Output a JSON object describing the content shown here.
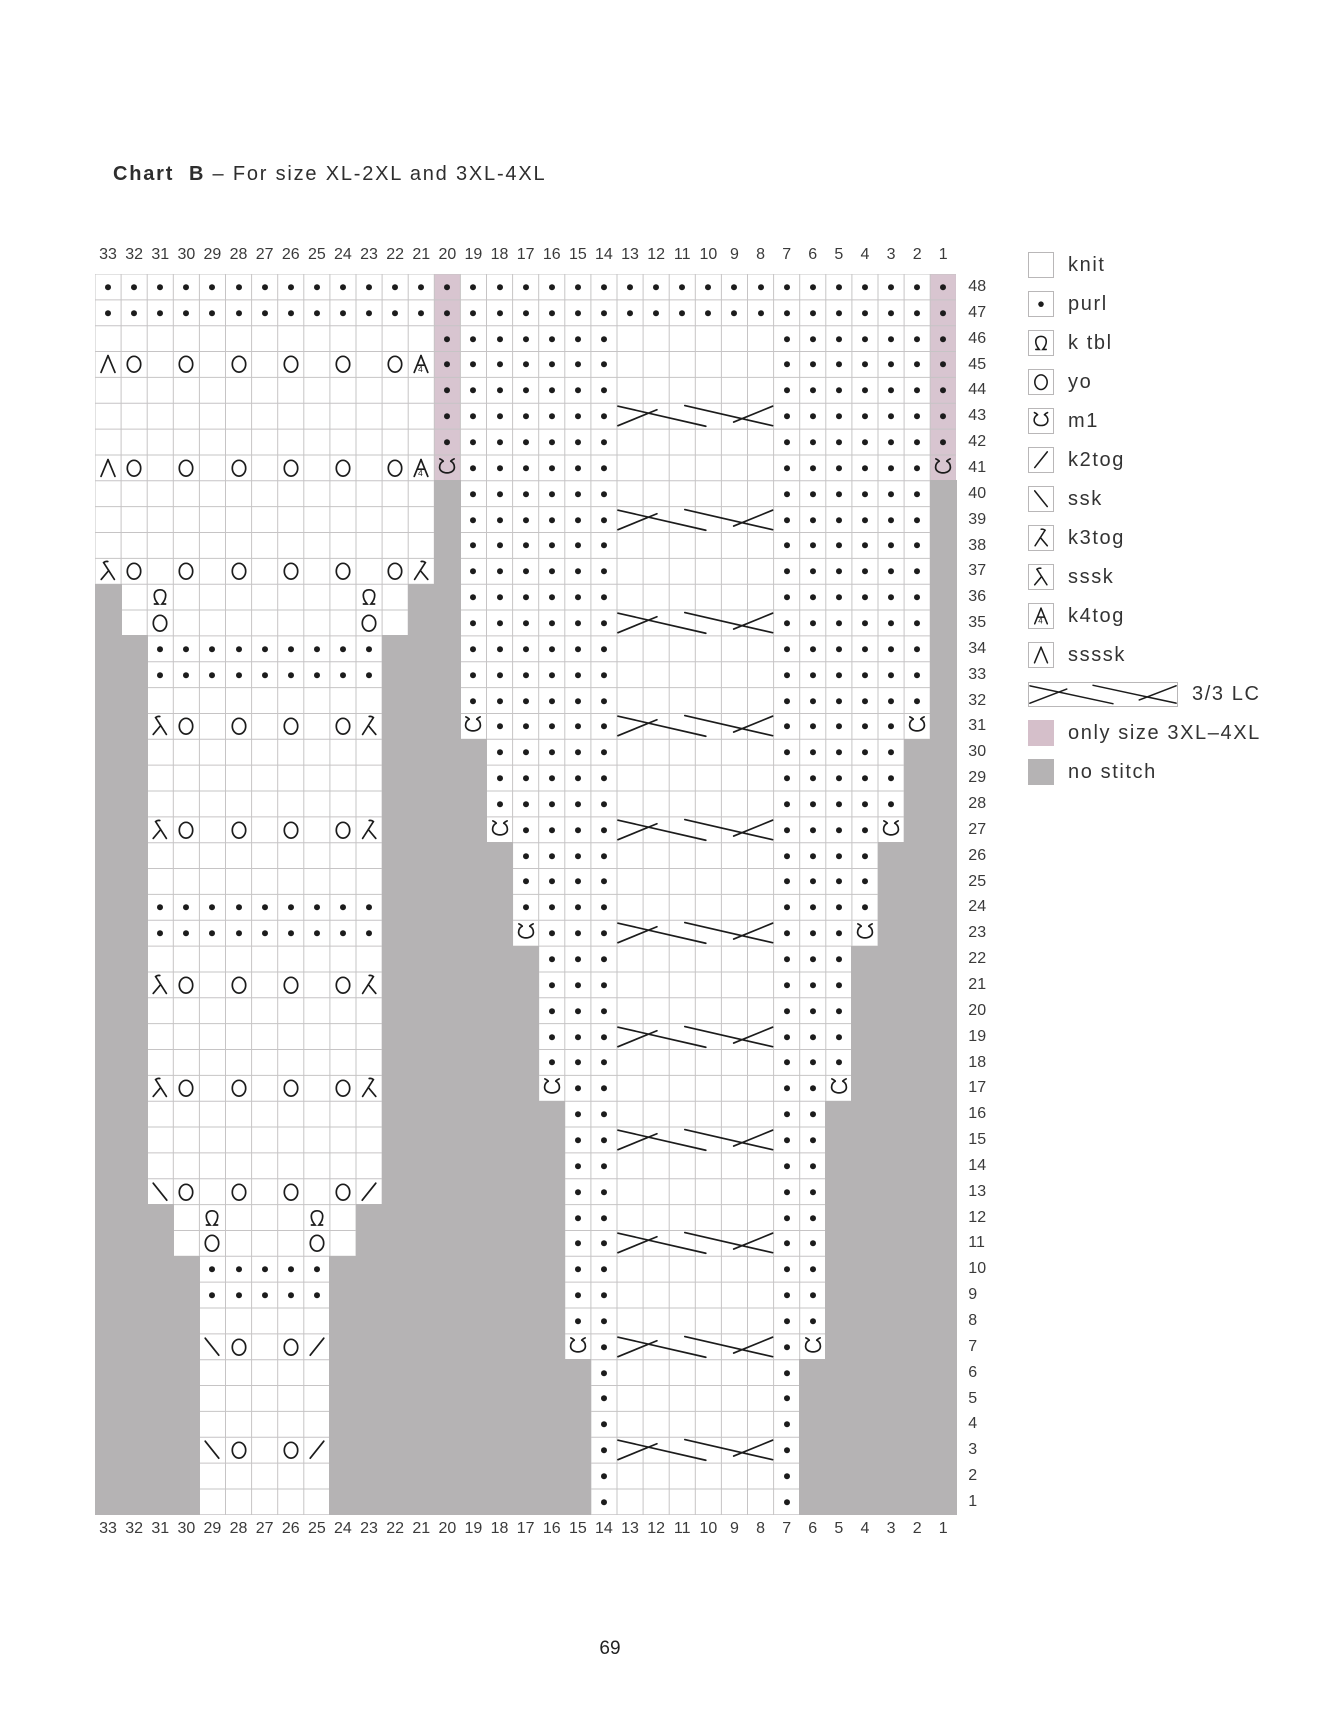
{
  "page": {
    "title_bold": "Chart  B",
    "title_rest": " – For size XL-2XL and 3XL-4XL",
    "page_number": "69"
  },
  "colors": {
    "pink": "#d8c5d0",
    "legend_pink": "#d5bfca",
    "gray": "#b5b3b4",
    "grid_line": "#c6c4c5",
    "symbol": "#1c1c1c",
    "label_text": "#3a3a3a"
  },
  "legend": {
    "items": [
      {
        "key": "knit",
        "label": "knit"
      },
      {
        "key": "purl",
        "label": "purl"
      },
      {
        "key": "ktbl",
        "label": "k tbl"
      },
      {
        "key": "yo",
        "label": "yo"
      },
      {
        "key": "m1",
        "label": "m1"
      },
      {
        "key": "k2tog",
        "label": "k2tog"
      },
      {
        "key": "ssk",
        "label": "ssk"
      },
      {
        "key": "k3tog",
        "label": "k3tog"
      },
      {
        "key": "sssk",
        "label": "sssk"
      },
      {
        "key": "k4tog",
        "label": "k4tog"
      },
      {
        "key": "ssssk",
        "label": "ssssk"
      },
      {
        "key": "cable",
        "label": "3/3 LC"
      },
      {
        "key": "only3xl",
        "label": "only size 3XL–4XL"
      },
      {
        "key": "nostitch",
        "label": "no stitch"
      }
    ]
  },
  "chart_data": {
    "type": "table",
    "subtype": "knitting-stitch-chart",
    "title": "Chart B – For size XL-2XL and 3XL-4XL",
    "column_labels": [
      33,
      32,
      31,
      30,
      29,
      28,
      27,
      26,
      25,
      24,
      23,
      22,
      21,
      20,
      19,
      18,
      17,
      16,
      15,
      14,
      13,
      12,
      11,
      10,
      9,
      8,
      7,
      6,
      5,
      4,
      3,
      2,
      1
    ],
    "column_labels_shown": "top and bottom",
    "row_labels": [
      48,
      47,
      46,
      45,
      44,
      43,
      42,
      41,
      40,
      39,
      38,
      37,
      36,
      35,
      34,
      33,
      32,
      31,
      30,
      29,
      28,
      27,
      26,
      25,
      24,
      23,
      22,
      21,
      20,
      19,
      18,
      17,
      16,
      15,
      14,
      13,
      12,
      11,
      10,
      9,
      8,
      7,
      6,
      5,
      4,
      3,
      2,
      1
    ],
    "row_labels_shown": "right side",
    "cell_tokens": {
      ".": "knit (empty cell)",
      "p": "purl",
      "Q": "k tbl",
      "O": "yo",
      "M": "m1",
      "/": "k2tog",
      "\\": "ssk",
      "K": "k3tog",
      "S": "sssk",
      "4": "k4tog",
      "A": "ssssk",
      "C": "3/3 LC cable (6-cell span)",
      "G": "no stitch (gray)",
      "P": "purl on pink = only size 3XL-4XL",
      "N": "m1 on pink = only size 3XL-4XL"
    },
    "rows": [
      "pppppppppppppPppppppppppppppppppP",
      "pppppppppppppPppppppppppppppppppP",
      ".............Ppppppp......ppppppP",
      "AO.O.O.O.O.O4Ppppppp......ppppppP",
      ".............Ppppppp......ppppppP",
      ".............PppppppCCCCCCppppppP",
      ".............Ppppppp......ppppppP",
      "AO.O.O.O.O.O4Npppppp......ppppppN",
      ".............Gpppppp......ppppppG",
      ".............GppppppCCCCCCppppppG",
      ".............Gpppppp......ppppppG",
      "SO.O.O.O.O.OKGpppppp......ppppppG",
      "G.Q.......Q.GGpppppp......ppppppG",
      "G.O.......O.GGppppppCCCCCCppppppG",
      "GGpppppppppGGGpppppp......ppppppG",
      "GGpppppppppGGGpppppp......ppppppG",
      "GG.........GGGpppppp......ppppppG",
      "GGSO.O.O.OKGGGMpppppCCCCCCpppppMG",
      "GG.........GGGGppppp......pppppGG",
      "GG.........GGGGppppp......pppppGG",
      "GG.........GGGGppppp......pppppGG",
      "GGSO.O.O.OKGGGGMppppCCCCCCppppMGG",
      "GG.........GGGGGpppp......ppppGGG",
      "GG.........GGGGGpppp......ppppGGG",
      "GGpppppppppGGGGGpppp......ppppGGG",
      "GGpppppppppGGGGGMpppCCCCCCpppMGGG",
      "GG.........GGGGGGppp......pppGGGG",
      "GGSO.O.O.OKGGGGGGppp......pppGGGG",
      "GG.........GGGGGGppp......pppGGGG",
      "GG.........GGGGGGpppCCCCCCpppGGGG",
      "GG.........GGGGGGppp......pppGGGG",
      "GGSO.O.O.OKGGGGGGMpp......ppMGGGG",
      "GG.........GGGGGGGpp......ppGGGGG",
      "GG.........GGGGGGGppCCCCCCppGGGGG",
      "GG.........GGGGGGGpp......ppGGGGG",
      "GG\\O.O.O.O/GGGGGGGpp......ppGGGGG",
      "GGG.Q...Q.GGGGGGGGpp......ppGGGGG",
      "GGG.O...O.GGGGGGGGppCCCCCCppGGGGG",
      "GGGGpppppGGGGGGGGGpp......ppGGGGG",
      "GGGGpppppGGGGGGGGGpp......ppGGGGG",
      "GGGG.....GGGGGGGGGpp......ppGGGGG",
      "GGGG\\O.O/GGGGGGGGGMpCCCCCCpMGGGGG",
      "GGGG.....GGGGGGGGGGp......pGGGGGG",
      "GGGG.....GGGGGGGGGGp......pGGGGGG",
      "GGGG.....GGGGGGGGGGp......pGGGGGG",
      "GGGG\\O.O/GGGGGGGGGGpCCCCCCpGGGGGG",
      "GGGG.....GGGGGGGGGGp......pGGGGGG",
      "GGGG.....GGGGGGGGGGp......pGGGGGG"
    ]
  }
}
